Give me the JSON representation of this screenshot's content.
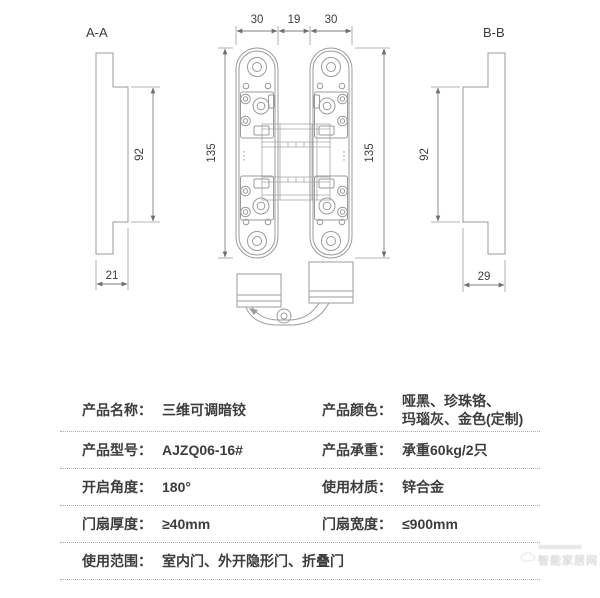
{
  "drawing": {
    "section_a": {
      "label": "A-A",
      "dim_body_height": "92",
      "dim_depth": "21"
    },
    "section_b": {
      "label": "B-B",
      "dim_body_height": "92",
      "dim_depth": "29"
    },
    "front_view": {
      "dim_plate_left": "30",
      "dim_gap": "19",
      "dim_plate_right": "30",
      "dim_total_height_left": "135",
      "dim_total_height_right": "135"
    }
  },
  "spec_table": {
    "rows": [
      {
        "label": "产品名称：",
        "value": "三维可调暗铰",
        "label2": "产品颜色：",
        "value2_line1": "哑黑、珍珠铬、",
        "value2_line2": "玛瑙灰、金色(定制)"
      },
      {
        "label": "产品型号：",
        "value": "AJZQ06-16#",
        "label2": "产品承重：",
        "value2": "承重60kg/2只"
      },
      {
        "label": "开启角度：",
        "value": "180°",
        "label2": "使用材质：",
        "value2": "锌合金"
      },
      {
        "label": "门扇厚度：",
        "value": "≥40mm",
        "label2": "门扇宽度：",
        "value2": "≤900mm"
      },
      {
        "label": "使用范围：",
        "value": "室内门、外开隐形门、折叠门"
      }
    ]
  },
  "watermark": {
    "text": "智能家居网"
  },
  "colors": {
    "line": "#9b9b9b",
    "dimension_line": "#7f7f7f",
    "text": "#3d3d3d",
    "dotted_separator": "#adadad",
    "background": "#ffffff"
  }
}
